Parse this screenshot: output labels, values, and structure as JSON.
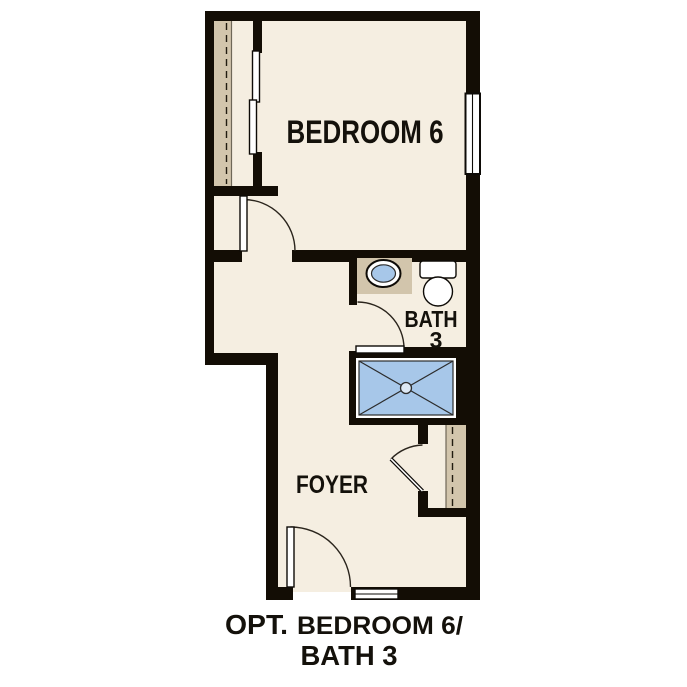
{
  "palette": {
    "background": "#ffffff",
    "floor": "#f5eee1",
    "wall": "#130d05",
    "closet_tan": "#d2c5ac",
    "water_blue": "#a7c7e9",
    "line": "#2a241c",
    "text": "#14110b"
  },
  "rooms": {
    "bedroom": {
      "label": "BEDROOM 6"
    },
    "bath": {
      "label": "BATH",
      "number": "3"
    },
    "foyer": {
      "label": "FOYER"
    }
  },
  "caption": {
    "opt": "OPT.",
    "title": "BEDROOM 6/",
    "line2": "BATH 3"
  },
  "fixtures": {
    "sink": "vanity-sink",
    "toilet": "toilet",
    "shower": "shower-pan-with-drain",
    "bedroom_closet": "closet-with-sliding-doors",
    "foyer_closet": "coat-closet",
    "window": "window",
    "threshold": "entry-threshold"
  }
}
